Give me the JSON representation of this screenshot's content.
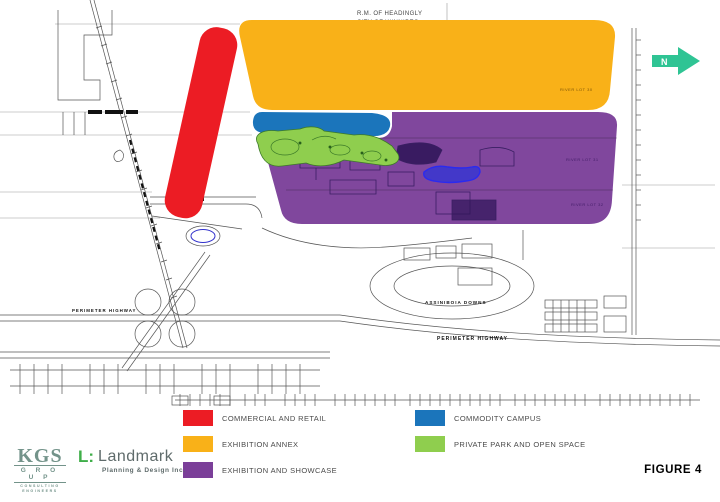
{
  "figure": {
    "label": "FIGURE 4"
  },
  "north_arrow": {
    "label": "N",
    "color": "#2fc494"
  },
  "boundary": {
    "top": "R.M. OF HEADINGLY",
    "bottom": "CITY OF WINNIPEG"
  },
  "map_labels": {
    "perimeter_left": "PERIMETER HIGHWAY",
    "perimeter_bottom": "PERIMETER  HIGHWAY",
    "racetrack": "ASSINIBOIA DOWNS",
    "lot_orange": "RIVER LOT 30",
    "lot_purple_1": "RIVER LOT 31",
    "lot_purple_2": "RIVER LOT 32"
  },
  "legend": {
    "items": [
      {
        "label": "COMMERCIAL AND RETAIL",
        "color": "#EC1C24"
      },
      {
        "label": "EXHIBITION ANNEX",
        "color": "#F9B118"
      },
      {
        "label": "EXHIBITION AND SHOWCASE",
        "color": "#7B3F99"
      },
      {
        "label": "COMMODITY CAMPUS",
        "color": "#1B75BB"
      },
      {
        "label": "PRIVATE PARK AND OPEN SPACE",
        "color": "#8FCE4E"
      }
    ]
  },
  "water": {
    "lake_fill": "#4338c9",
    "lake_stroke": "#2a2af0",
    "pond_stroke": "#3333cc"
  },
  "logos": {
    "kgs": {
      "name": "KGS",
      "group": "G R O U P",
      "tag1": "CONSULTING",
      "tag2": "ENGINEERS"
    },
    "landmark": {
      "mark": "L:",
      "name": "Landmark",
      "tagline": "Planning & Design Inc."
    }
  }
}
